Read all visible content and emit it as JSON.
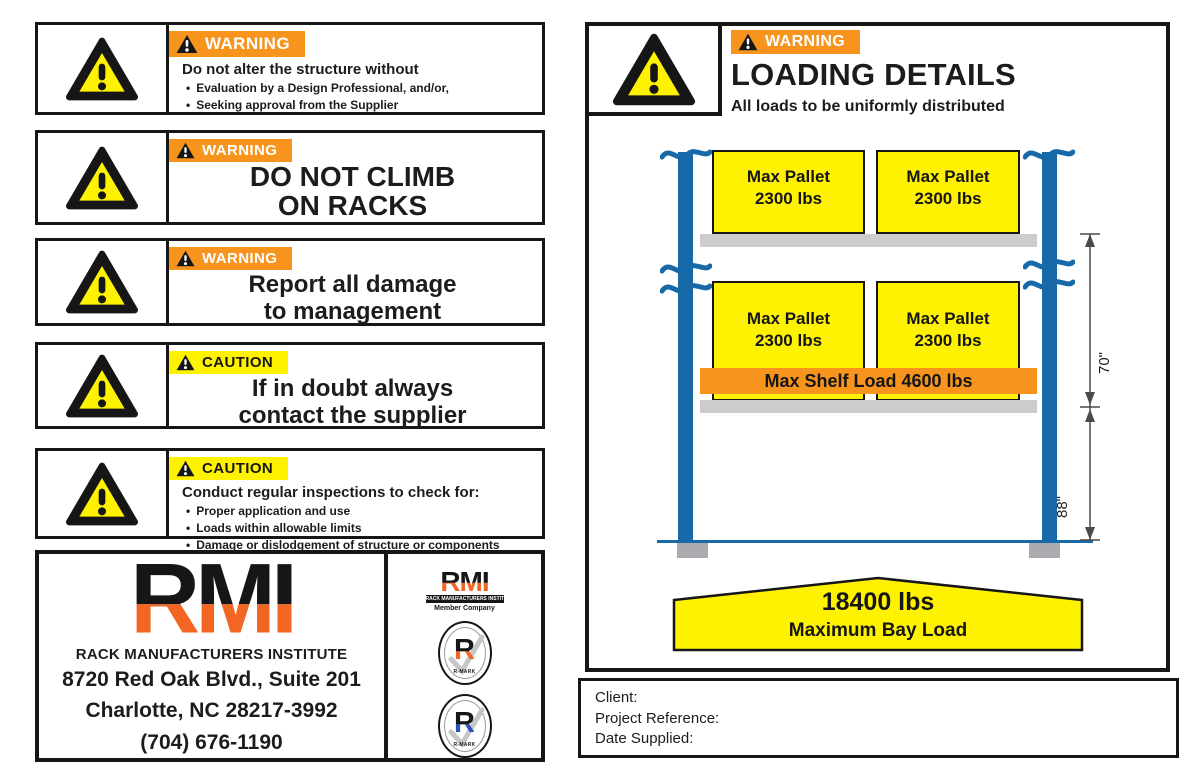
{
  "ui": {
    "bullet": "•"
  },
  "colors": {
    "warning_orange": "#F7941D",
    "caution_yellow": "#FFF200",
    "rmi_orange": "#F26522",
    "post_blue": "#1769A8",
    "beam_gray": "#CBCCCE",
    "seal_blue": "#2A52BE",
    "border_black": "#161616"
  },
  "left_panels": {
    "p1": {
      "banner": "WARNING",
      "heading": "Do not alter the structure without",
      "bullets": [
        "Evaluation by a Design Professional, and/or,",
        "Seeking approval from the Supplier"
      ]
    },
    "p2": {
      "banner": "WARNING",
      "line1": "DO NOT CLIMB",
      "line2": "ON RACKS"
    },
    "p3": {
      "banner": "WARNING",
      "line1": "Report all damage",
      "line2": "to management"
    },
    "p4": {
      "banner": "CAUTION",
      "line1": "If in doubt always",
      "line2": "contact the supplier"
    },
    "p5": {
      "banner": "CAUTION",
      "heading": "Conduct regular inspections to check for:",
      "bullets": [
        "Proper application and use",
        "Loads within allowable limits",
        "Damage or dislodgement of structure or components"
      ]
    }
  },
  "rmi": {
    "logo": "RMI",
    "org": "RACK MANUFACTURERS INSTITUTE",
    "address_line1": "8720 Red Oak Blvd., Suite 201",
    "address_line2": "Charlotte, NC 28217-3992",
    "phone": "(704) 676-1190",
    "member_label": "Member Company",
    "rmark_label": "R-MARK",
    "seal_letter": "R"
  },
  "loading_details": {
    "banner": "WARNING",
    "title": "LOADING DETAILS",
    "subtitle": "All loads to be uniformly distributed",
    "pallet": {
      "line1": "Max Pallet",
      "line2": "2300 lbs"
    },
    "shelf_load": "Max Shelf Load 4600 lbs",
    "dims": {
      "beam_spacing": "70\"",
      "first_beam_height": "88\""
    },
    "bay_load": {
      "value": "18400 lbs",
      "label": "Maximum Bay Load"
    },
    "fields": {
      "client": "Client:",
      "project": "Project Reference:",
      "date": "Date Supplied:"
    }
  }
}
